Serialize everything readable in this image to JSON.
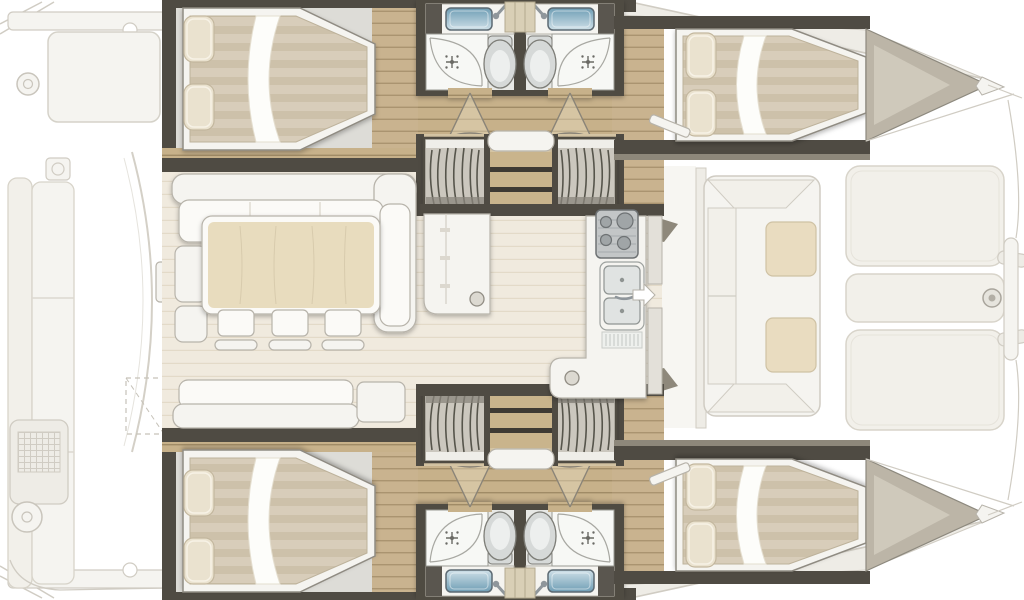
{
  "meta": {
    "diagram_kind": "catamaran-yacht-deck-floor-plan",
    "orientation": "bow-right-stern-left",
    "symmetry": "mirrored-port-and-starboard-hulls"
  },
  "plan": {
    "hulls": [
      {
        "id": "hull-top",
        "cabins": [
          "aft-double-cabin-with-island-bed",
          "forward-double-cabin-with-island-bed"
        ],
        "bathrooms": [
          {
            "fixtures": [
              "sink-with-faucet",
              "shower-with-sprinkler-symbol",
              "toilet"
            ]
          },
          {
            "fixtures": [
              "sink-with-faucet",
              "shower-with-sprinkler-symbol",
              "toilet"
            ]
          }
        ],
        "circulation": [
          "hallway-with-two-door-swings",
          "companionway-steps",
          "curved-slatted-stairs-x2"
        ],
        "bow": "pointed-bow-with-anchor-deck"
      },
      {
        "id": "hull-bottom",
        "cabins": [
          "aft-double-cabin-with-island-bed",
          "forward-double-cabin-with-island-bed"
        ],
        "bathrooms": [
          {
            "fixtures": [
              "sink-with-faucet",
              "shower-with-sprinkler-symbol",
              "toilet"
            ]
          },
          {
            "fixtures": [
              "sink-with-faucet",
              "shower-with-sprinkler-symbol",
              "toilet"
            ]
          }
        ],
        "circulation": [
          "hallway-with-two-door-swings",
          "companionway-steps",
          "curved-slatted-stairs-x2"
        ],
        "bow": "pointed-bow-with-anchor-deck"
      }
    ],
    "salon": {
      "furniture": [
        "l-shaped-sofa",
        "two-stools",
        "dining-table",
        "three-chairs",
        "aft-sofa",
        "side-table",
        "storage-cabinet-with-round-handle"
      ],
      "galley": [
        "stove-four-burners",
        "double-sink-with-faucet",
        "drainboard",
        "counter-with-return"
      ],
      "entry": "white-arrow-marker-pointing-to-bow-door"
    },
    "exterior": {
      "aft_cockpit": [
        "transom-steps",
        "beam",
        "cockpit-table",
        "winch",
        "cup-holder",
        "long-bench-sofa",
        "fridge-grill-module",
        "large-winch",
        "tilting-door-arc",
        "dashed-storage-outline",
        "door-jamb"
      ],
      "foredeck": [
        "coachroof-front-panels",
        "u-shaped-lounge",
        "two-lounge-tables",
        "three-sunpad-cushions",
        "hinge-tabs",
        "forestay-fitting",
        "bow-deck-edge"
      ]
    }
  },
  "colors": {
    "wall": "#4f4b43",
    "wallmid": "#8e887b",
    "woodc": "#c7b18a",
    "woodcLine": "#a08b66",
    "woodf": "#c9b38f",
    "woodfLine": "#aa9470",
    "woodl": "#d6c6a5",
    "woodlLine": "#b7a481",
    "salon": "#f0eade",
    "salonLine": "#e3dac8",
    "tread": "#c9b48c",
    "gap": "#3e3a33",
    "white1": "#f5f4f0",
    "white2": "#fbfaf7",
    "outl": "#b7b3aa",
    "outd": "#8f8b82",
    "graybed": "#dddcd7",
    "matt1": "#d8cdba",
    "matt2": "#cdc1aa",
    "pillow": "#eae2cf",
    "pillowEdge": "#c3b79e",
    "sheet": "#fdfdfa",
    "bath": "#e7e8e5",
    "bathShower": "#f7f8f5",
    "fixline": "#9a9a93",
    "fixgray": "#d6d9d8",
    "fixlight": "#edefee",
    "tealTop": "#6e9db4",
    "tealBot": "#cfe0e8",
    "sinkEdge": "#5d6b73",
    "shelf": "#d9cfb6",
    "stove": "#c3c6c7",
    "stoveDark": "#6e7274",
    "burner": "#a0a5a7",
    "deck": "#bcb5a7",
    "deckLight": "#cfc9bb",
    "table": "#e8dcbe",
    "tableLine": "#cdc0a2",
    "fadedFill": "#f5f4f0",
    "faded2": "#eeece6",
    "fadedLine": "#d0ccc3",
    "fadedCush": "#f2f0ea",
    "slatBg": "#cbc7be",
    "slat": "#57544c",
    "slatShadow": "#8a867c",
    "arrow": "#ffffff",
    "metal": "#8f969b",
    "doorFill": "#e9ddc2"
  }
}
